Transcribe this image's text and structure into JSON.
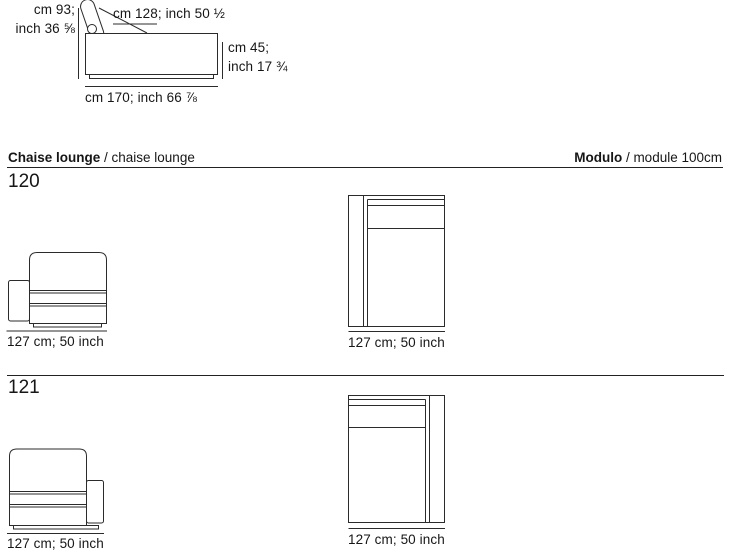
{
  "colors": {
    "line": "#2b2b2b",
    "text": "#161616",
    "background": "#ffffff"
  },
  "side_diagram": {
    "height_label_line1": "cm 93;",
    "height_label_line2": "inch 36 ⅝",
    "top_width_label": "cm 128; inch 50 ½",
    "seat_height_label_line1": "cm 45;",
    "seat_height_label_line2": "inch 17 ¾",
    "depth_label": "cm 170; inch 66 ⅞"
  },
  "header": {
    "left_title": "Chaise lounge",
    "left_subtitle": " / chaise lounge",
    "right_title": "Modulo",
    "right_subtitle": " / module 100cm"
  },
  "sections": [
    {
      "code": "120",
      "front_dimension": "127 cm; 50 inch",
      "top_dimension": "127 cm; 50 inch"
    },
    {
      "code": "121",
      "front_dimension": "127 cm; 50 inch",
      "top_dimension": "127 cm; 50 inch"
    }
  ]
}
